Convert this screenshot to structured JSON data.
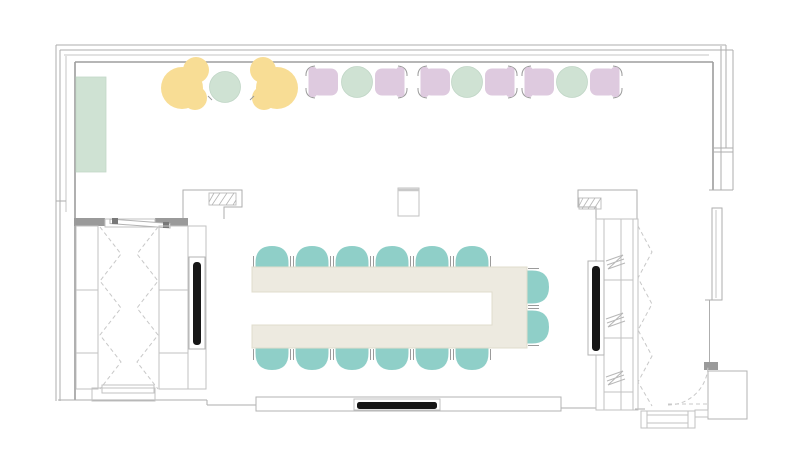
{
  "document": {
    "type": "floor-plan",
    "room": "meeting-room"
  },
  "colors": {
    "wall": "#aeaeae",
    "wall_dark": "#9a9a9a",
    "table_fill": "#edeae0",
    "teal_chair": "#8fcfc8",
    "sage_green": "#cfe2d3",
    "yellow_chair": "#f8dd95",
    "purple_chair": "#decadf",
    "display_black": "#161616",
    "background": "#ffffff"
  },
  "furniture": {
    "conference_table": {
      "item": "u-shaped-conference-table",
      "seats": 14
    },
    "task_chairs": {
      "item": "conference-chair",
      "count": 14
    },
    "lounge_chairs": {
      "item": "yellow-lounge-chair",
      "count": 2
    },
    "guest_chairs": {
      "item": "purple-guest-chair",
      "count": 6
    },
    "side_tables": {
      "item": "round-side-table",
      "count": 4
    },
    "sideboard": {
      "item": "sideboard",
      "count": 1
    },
    "displays": {
      "item": "wall-display",
      "count": 3
    },
    "closets": {
      "item": "storage-closet-folding-doors",
      "count": 2
    },
    "entry": {
      "item": "entry-door-with-swing",
      "count": 1
    }
  }
}
